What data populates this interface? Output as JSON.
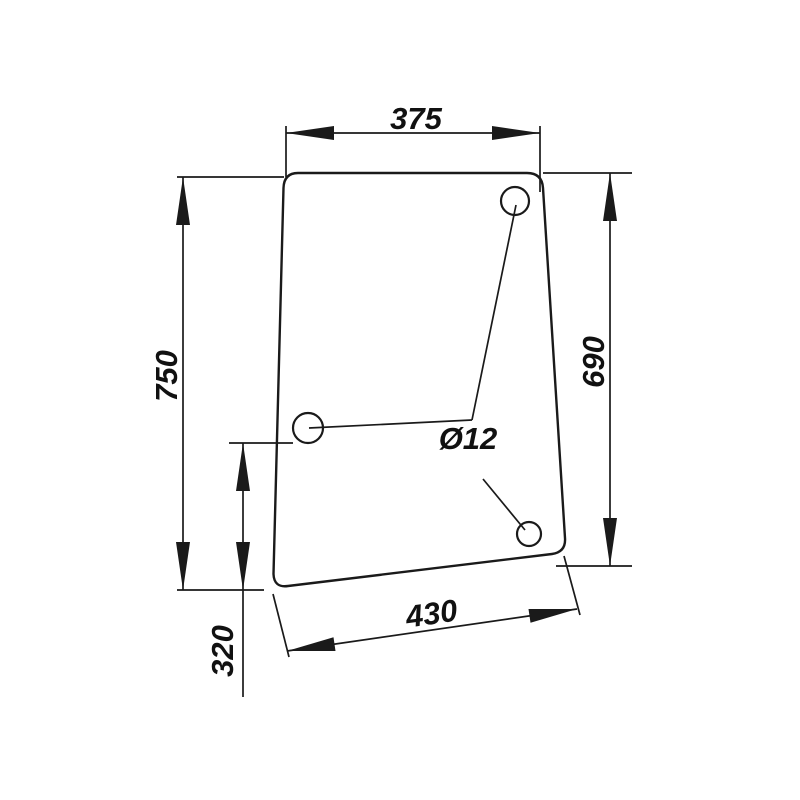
{
  "drawing": {
    "labels": {
      "top_width": "375",
      "left_height": "750",
      "right_height": "690",
      "hole_offset": "320",
      "bottom_width": "430",
      "hole_diameter": "Ø12"
    },
    "colors": {
      "line": "#1a1a1a",
      "background": "#ffffff"
    }
  }
}
